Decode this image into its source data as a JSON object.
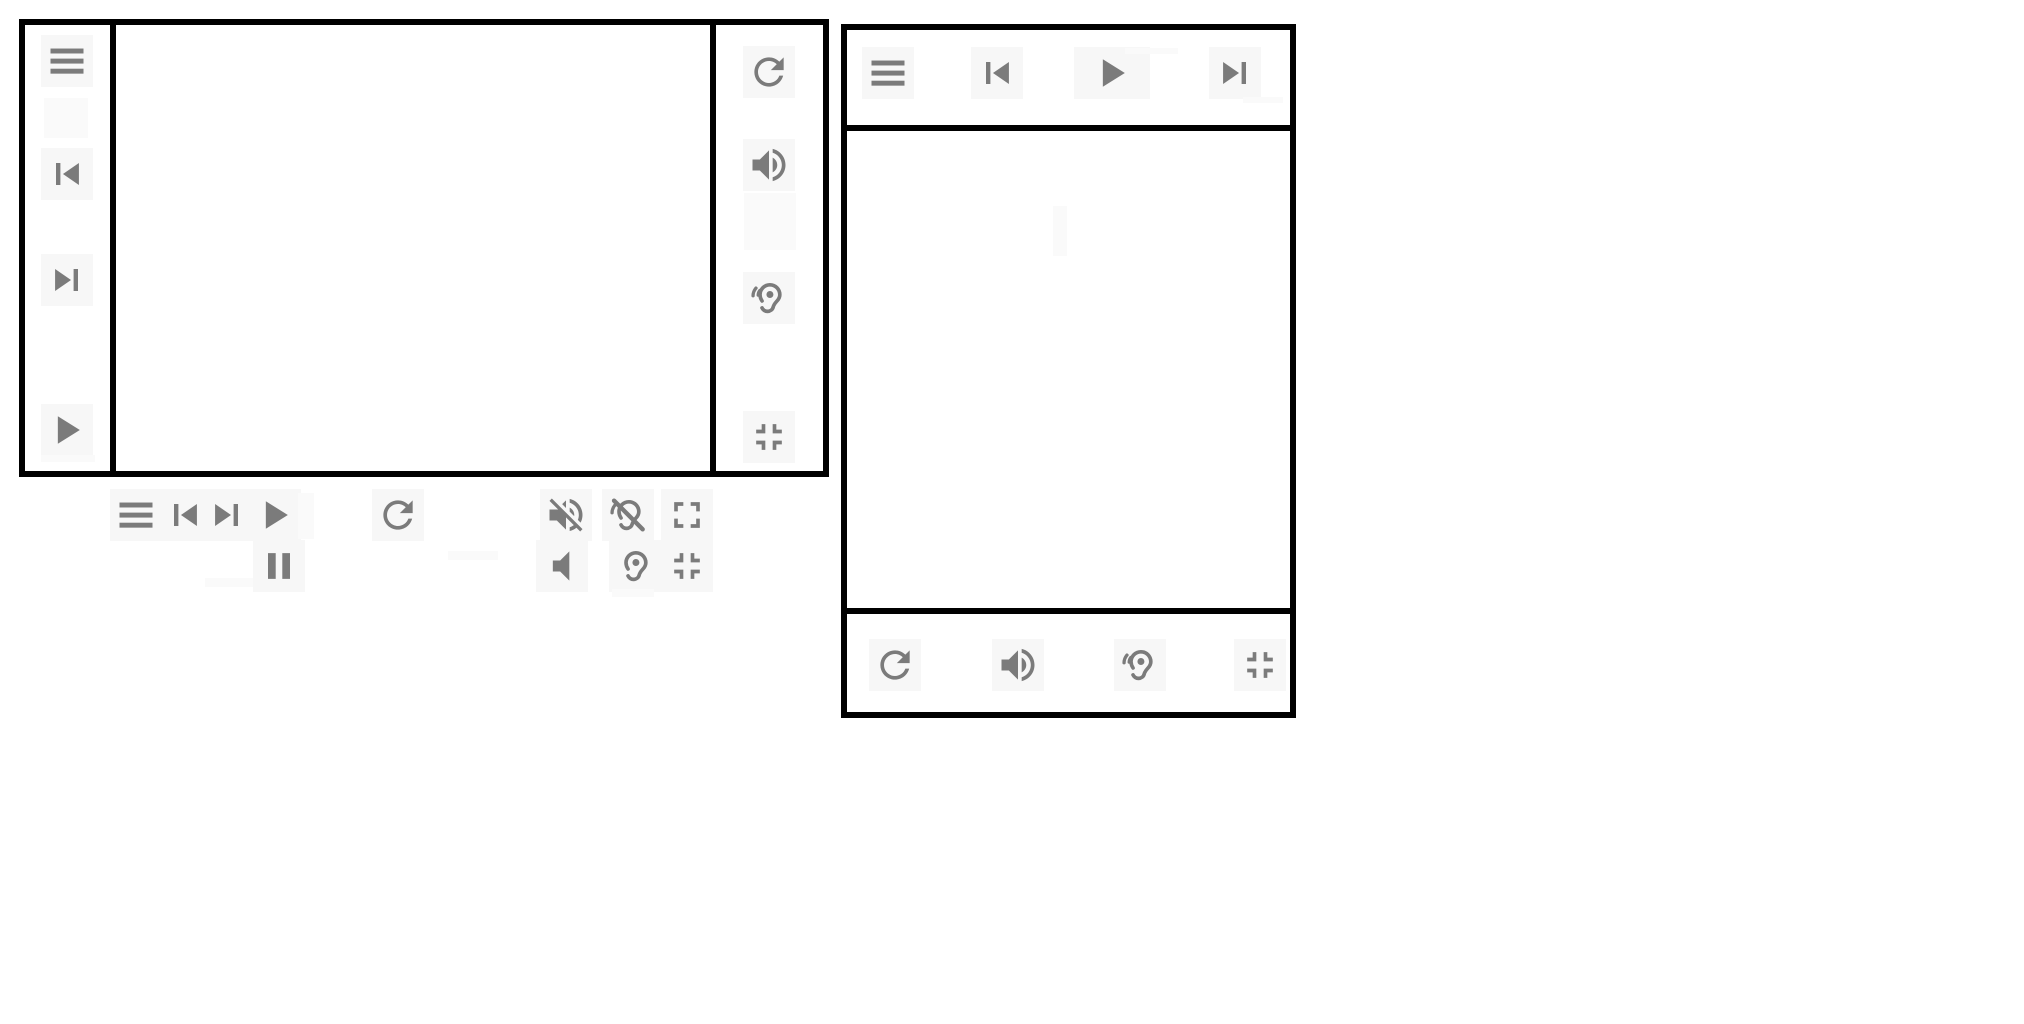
{
  "app": {
    "description": "Media player control panel mockups with icon toolbars",
    "visible_text": ""
  },
  "colors": {
    "border": "#000000",
    "icon": "#7b7b7b",
    "chip": "#f7f7f7",
    "background": "#ffffff",
    "artifact": "#fafafa"
  },
  "icons": {
    "menu": "hamburger-menu",
    "skip-previous": "skip-to-previous-track",
    "skip-next": "skip-to-next-track",
    "play": "play",
    "pause": "pause",
    "refresh": "reload-refresh",
    "volume-up": "speaker-with-sound-waves",
    "volume-off": "speaker-muted-with-slash",
    "volume-mute": "speaker-without-waves",
    "hearing": "ear-with-sound-waves",
    "hearing-no-waves": "ear-without-waves",
    "hearing-disabled": "ear-with-slash",
    "fullscreen": "expand-fullscreen-corners-out",
    "fullscreen-exit": "collapse-fullscreen-corners-in"
  },
  "left_panel": {
    "left_column": {
      "controls": [
        {
          "icon": "menu"
        },
        {
          "icon": "skip-previous"
        },
        {
          "icon": "skip-next"
        },
        {
          "icon": "play"
        }
      ]
    },
    "right_column": {
      "controls": [
        {
          "icon": "refresh"
        },
        {
          "icon": "volume-up"
        },
        {
          "icon": "hearing"
        },
        {
          "icon": "fullscreen-exit"
        }
      ]
    },
    "content": ""
  },
  "controls_strip": {
    "row1": [
      {
        "icon": "menu"
      },
      {
        "icon": "skip-previous"
      },
      {
        "icon": "skip-next"
      },
      {
        "icon": "play"
      },
      {
        "icon": "refresh"
      },
      {
        "icon": "volume-off"
      },
      {
        "icon": "hearing-disabled"
      },
      {
        "icon": "fullscreen"
      }
    ],
    "row2": [
      {
        "icon": "pause"
      },
      {
        "icon": "volume-mute"
      },
      {
        "icon": "hearing-no-waves"
      },
      {
        "icon": "fullscreen-exit"
      }
    ]
  },
  "right_panel": {
    "top_bar": {
      "controls": [
        {
          "icon": "menu"
        },
        {
          "icon": "skip-previous"
        },
        {
          "icon": "play"
        },
        {
          "icon": "skip-next"
        }
      ]
    },
    "bottom_bar": {
      "controls": [
        {
          "icon": "refresh"
        },
        {
          "icon": "volume-up"
        },
        {
          "icon": "hearing"
        },
        {
          "icon": "fullscreen-exit"
        }
      ]
    },
    "content": ""
  }
}
